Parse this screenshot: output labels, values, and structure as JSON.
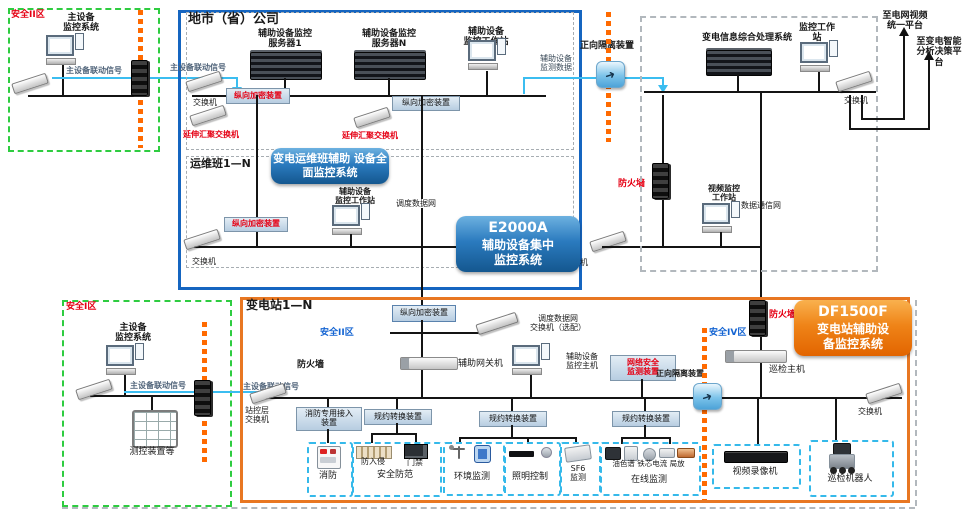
{
  "zone_tl": {
    "zone": "安全II区",
    "system": "主设备\n监控系统",
    "signal": "主设备联动信号"
  },
  "city": {
    "title": "地市（省）公司",
    "server1": "辅助设备监控\n服务器1",
    "serverN": "辅助设备监控\n服务器N",
    "workstation": "辅助设备\n监控工作站",
    "signal_in": "主设备联动信号",
    "switch": "交换机",
    "encrypt1": "纵向加密装置",
    "encrypt2": "纵向加密装置",
    "agg_switch1": "延伸汇聚交换机",
    "agg_switch2": "延伸汇聚交换机",
    "dispatch_net": "调度数据网",
    "aux_data": "辅助设备\n监测数据"
  },
  "ops": {
    "title": "运维班1—N",
    "badge": "变电运维班辅助\n设备全面监控系统",
    "workstation": "辅助设备\n监控工作站",
    "encrypt": "纵向加密装置",
    "switch_left": "交换机",
    "switch_right": "交换机"
  },
  "e2000a": {
    "line1": "E2000A",
    "line2": "辅助设备集中",
    "line3": "监控系统"
  },
  "iso_top": {
    "label": "正向隔离装置"
  },
  "corp": {
    "info_system": "变电信息综合处理系统",
    "monitor_ws": "监控工作\n站",
    "switch": "交换机",
    "firewall": "防火墙",
    "video_ws": "视频监控\n工作站",
    "data_net": "数据通信网",
    "to_video_platform": "至电网视频\n统一平台",
    "to_ai_platform": "至变电智能\n分析决策平\n台"
  },
  "zone_bl": {
    "zone": "安全I区",
    "system": "主设备\n监控系统",
    "signal": "主设备联动信号",
    "meter": "测控装置等"
  },
  "station": {
    "title": "变电站1—N",
    "encrypt": "纵向加密装置",
    "zone2": "安全II区",
    "zone4": "安全IV区",
    "firewall": "防火墙",
    "firewall_video": "防火墙",
    "dispatch_switch": "调度数据网\n交换机（选配）",
    "gateway": "辅助网关机",
    "aux_host": "辅助设备\n监控主机",
    "netsec": "网络安全\n监测装置",
    "forward_iso": "正向隔离装置",
    "patrol_host": "巡检主机",
    "signal": "主设备联动信号",
    "station_switch": "站控层\n交换机",
    "fire_access": "消防专用接入\n装置",
    "proto1": "规约转换装置",
    "proto2": "规约转换装置",
    "proto3": "规约转换装置",
    "switch_right": "交换机"
  },
  "df1500f": {
    "line1": "DF1500F",
    "line2": "变电站辅助设",
    "line3": "备监控系统"
  },
  "equip": {
    "fire": "消防",
    "security": "安全防范",
    "intrusion": "防入侵",
    "door": "门禁",
    "env": "环境监测",
    "light": "照明控制",
    "sf6": "SF6\n监测",
    "online": "在线监测",
    "online_items": "油色谱 铁芯电流 局放",
    "vcr": "视频录像机",
    "robot": "巡检机器人"
  }
}
